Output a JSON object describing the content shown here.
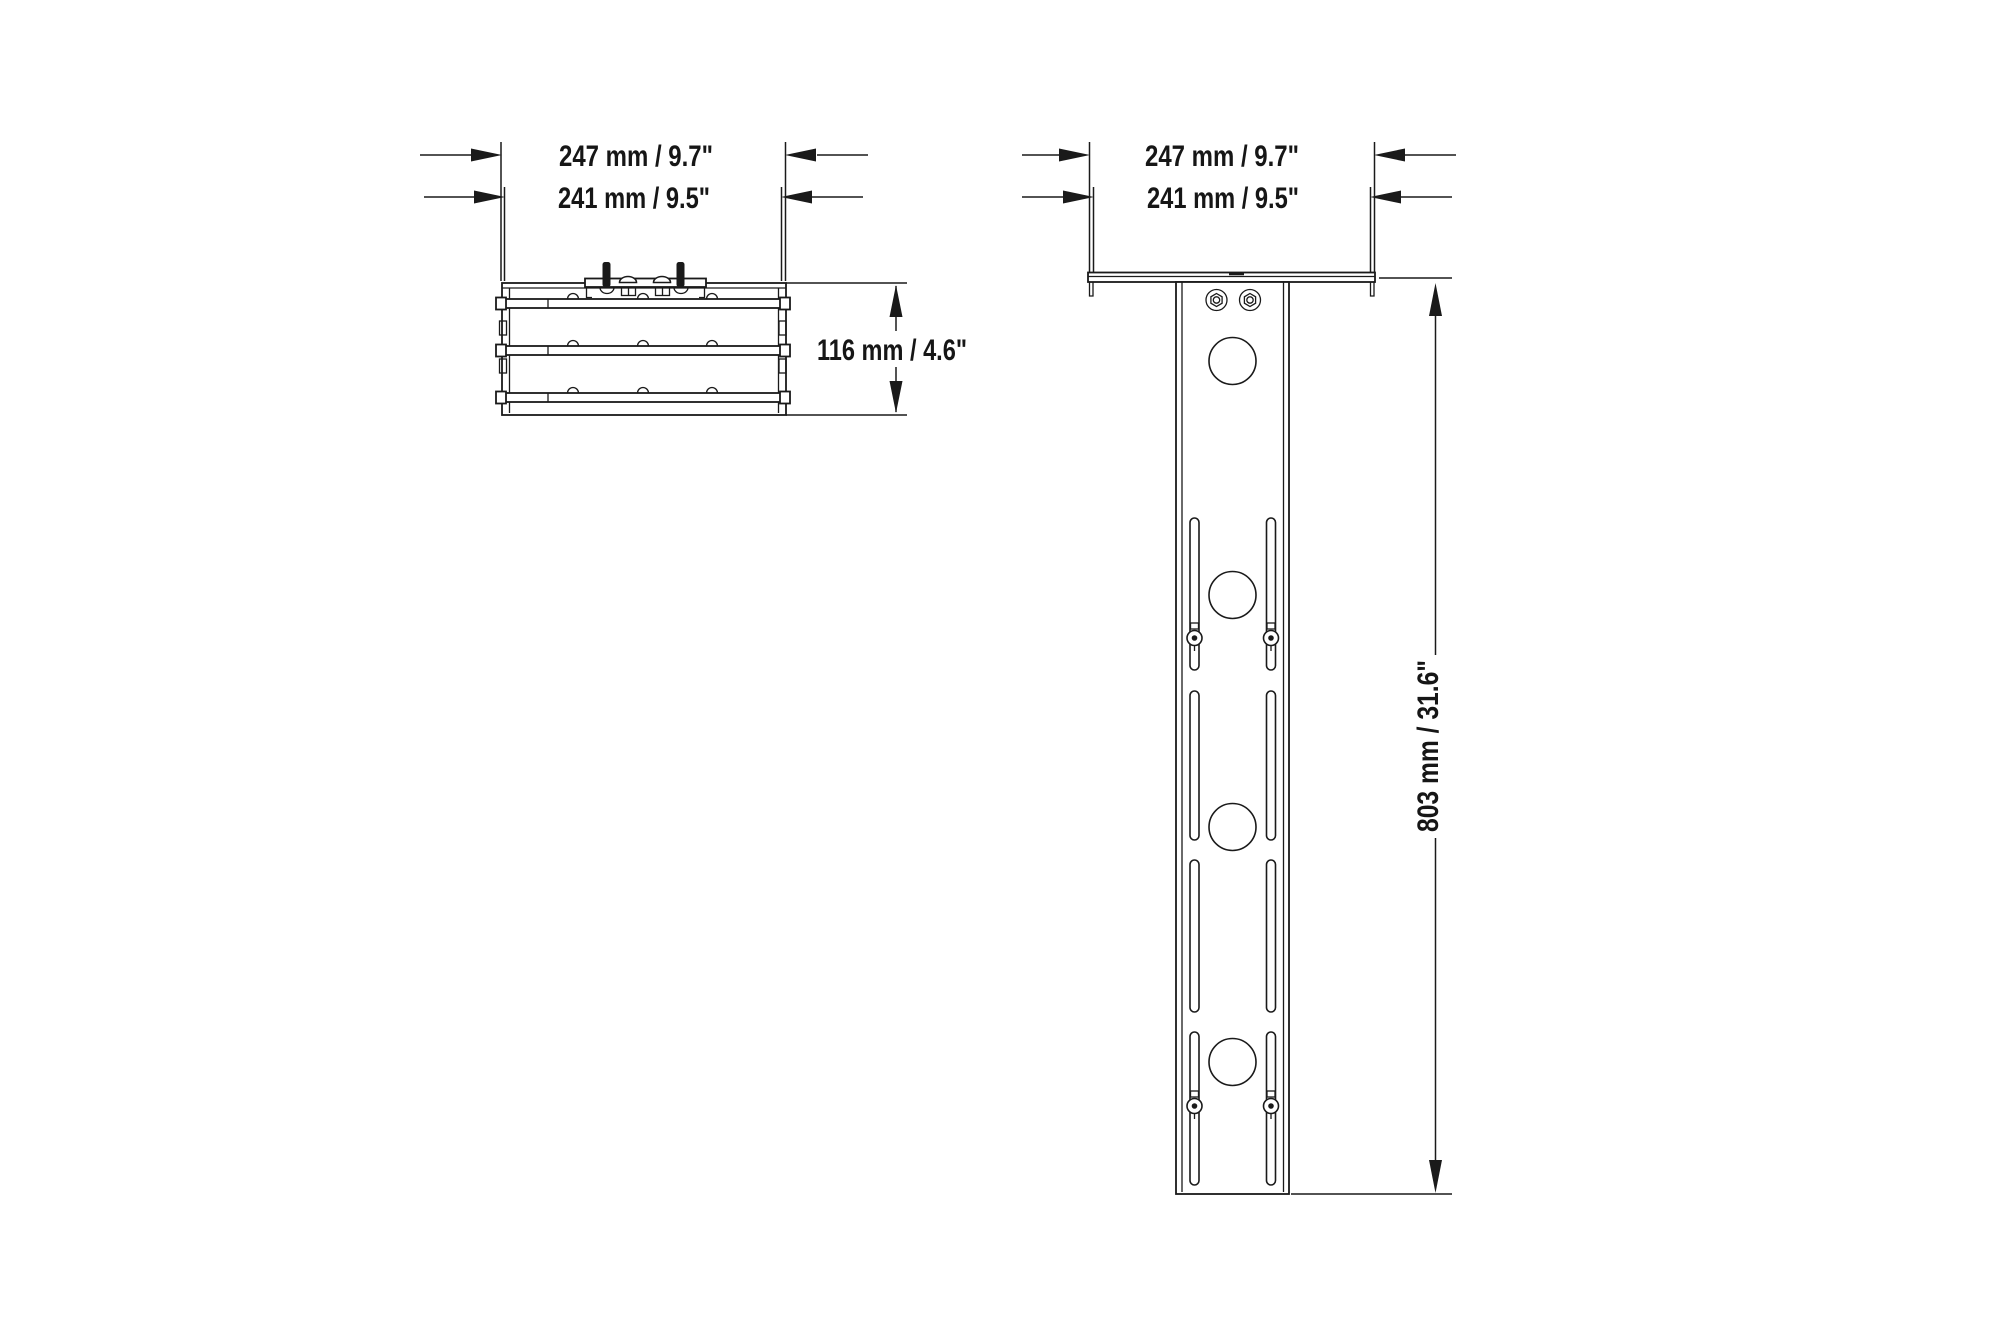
{
  "colors": {
    "background": "#ffffff",
    "ink": "#1a1a1a"
  },
  "side_view": {
    "dim_width_outer": "247 mm / 9.7\"",
    "dim_width_inner": "241 mm / 9.5\"",
    "dim_height": "116 mm / 4.6\""
  },
  "front_view": {
    "dim_width_outer": "247 mm / 9.7\"",
    "dim_width_inner": "241 mm / 9.5\"",
    "dim_height": "803 mm / 31.6\""
  }
}
